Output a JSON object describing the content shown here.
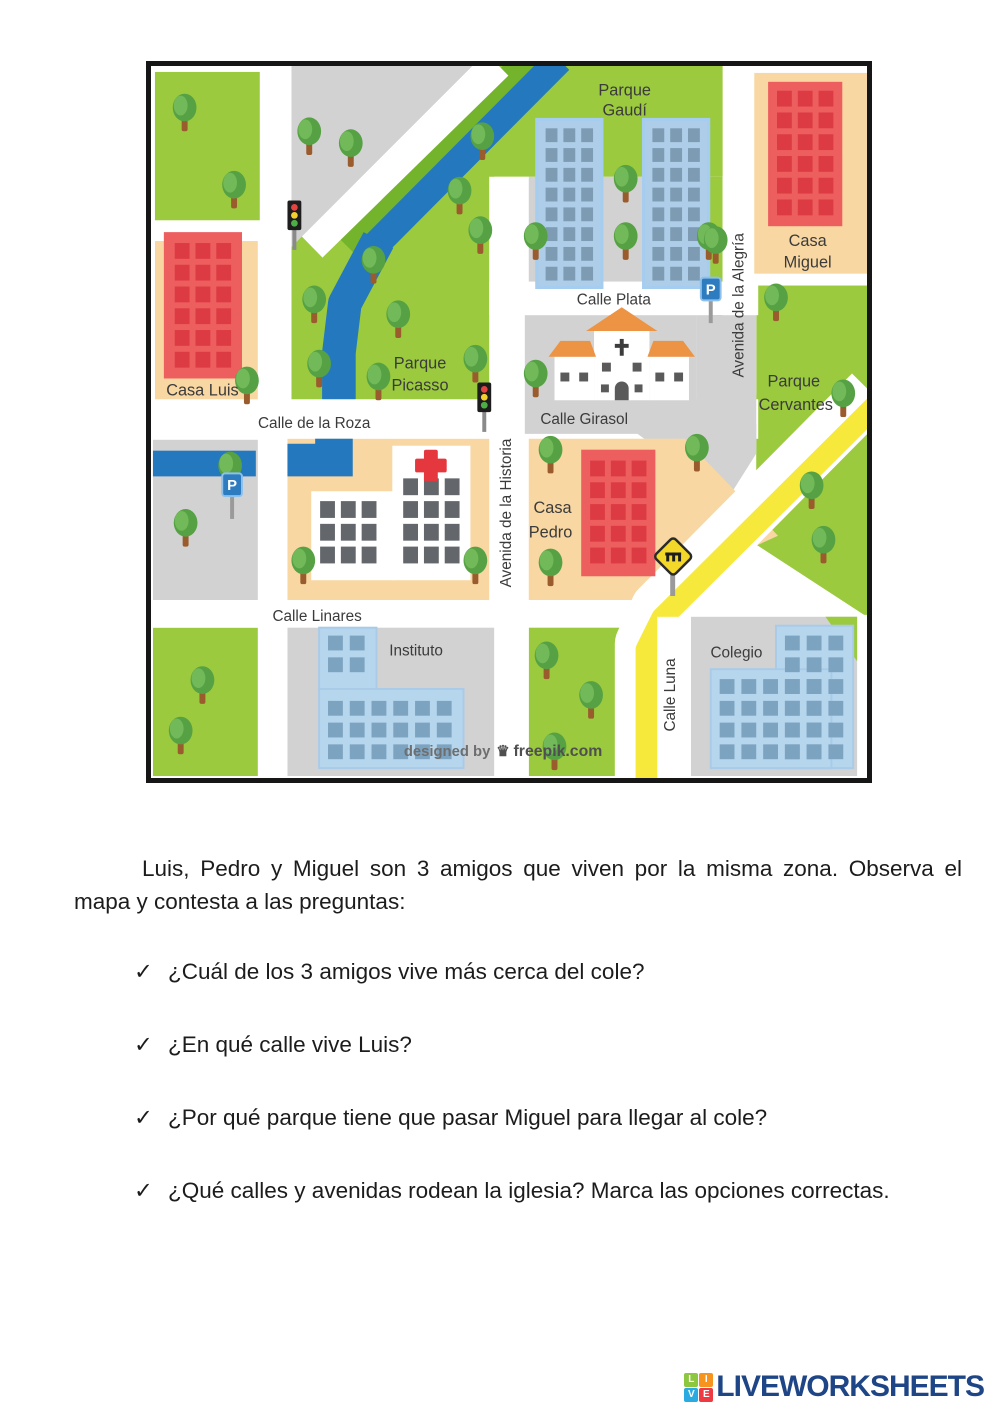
{
  "map": {
    "areas": {
      "parque_gaudi": {
        "line1": "Parque",
        "line2": "Gaudí"
      },
      "parque_picasso": {
        "line1": "Parque",
        "line2": "Picasso"
      },
      "parque_cervantes": {
        "line1": "Parque",
        "line2": "Cervantes"
      },
      "casa_luis": {
        "label": "Casa Luis"
      },
      "casa_miguel": {
        "line1": "Casa",
        "line2": "Miguel"
      },
      "casa_pedro": {
        "line1": "Casa",
        "line2": "Pedro"
      },
      "instituto": {
        "label": "Instituto"
      },
      "colegio": {
        "label": "Colegio"
      }
    },
    "streets": {
      "calle_plata": "Calle Plata",
      "calle_girasol": "Calle Girasol",
      "calle_de_la_roza": "Calle de la Roza",
      "calle_linares": "Calle Linares",
      "calle_luna": "Calle Luna",
      "avenida_alegria": "Avenida de la Alegría",
      "avenida_historia": "Avenida de la Historia"
    },
    "signs": {
      "parking": "P"
    },
    "watermark": {
      "prefix": "designed by",
      "brand": "freepik.com",
      "crown": "♛"
    },
    "colors": {
      "park_green": "#9bca3e",
      "dark_green": "#74b42c",
      "water": "#2478bd",
      "road_white": "#ffffff",
      "block_gray": "#d2d2d2",
      "block_peach": "#f8d7a2",
      "red_building": "#ed5e5f",
      "red_window": "#dd3b44",
      "blue_building": "#aecde8",
      "blue_window": "#7d9cb4",
      "school_building": "#b6d6ee",
      "school_window": "#7ca3c0",
      "hospital_window": "#63676b",
      "cross_red": "#e5383e",
      "road_yellow": "#f6e93c",
      "sign_blue": "#2e7cc0",
      "roof_orange": "#ec9344"
    }
  },
  "worksheet": {
    "intro": "Luis, Pedro y Miguel son 3 amigos que viven por la misma zona. Observa el mapa y contesta a las preguntas:",
    "bullet": "✓",
    "questions": [
      "¿Cuál de los 3 amigos vive más cerca del cole?",
      "¿En qué calle vive Luis?",
      "¿Por qué parque tiene que pasar Miguel para llegar al cole?",
      "¿Qué calles y avenidas rodean la iglesia? Marca las opciones correctas."
    ]
  },
  "footer": {
    "brand": "LIVEWORKSHEETS",
    "tiles": [
      {
        "letter": "L",
        "color": "#8dc63f"
      },
      {
        "letter": "I",
        "color": "#f7941e"
      },
      {
        "letter": "V",
        "color": "#29abe2"
      },
      {
        "letter": "E",
        "color": "#ee3a43"
      }
    ]
  }
}
